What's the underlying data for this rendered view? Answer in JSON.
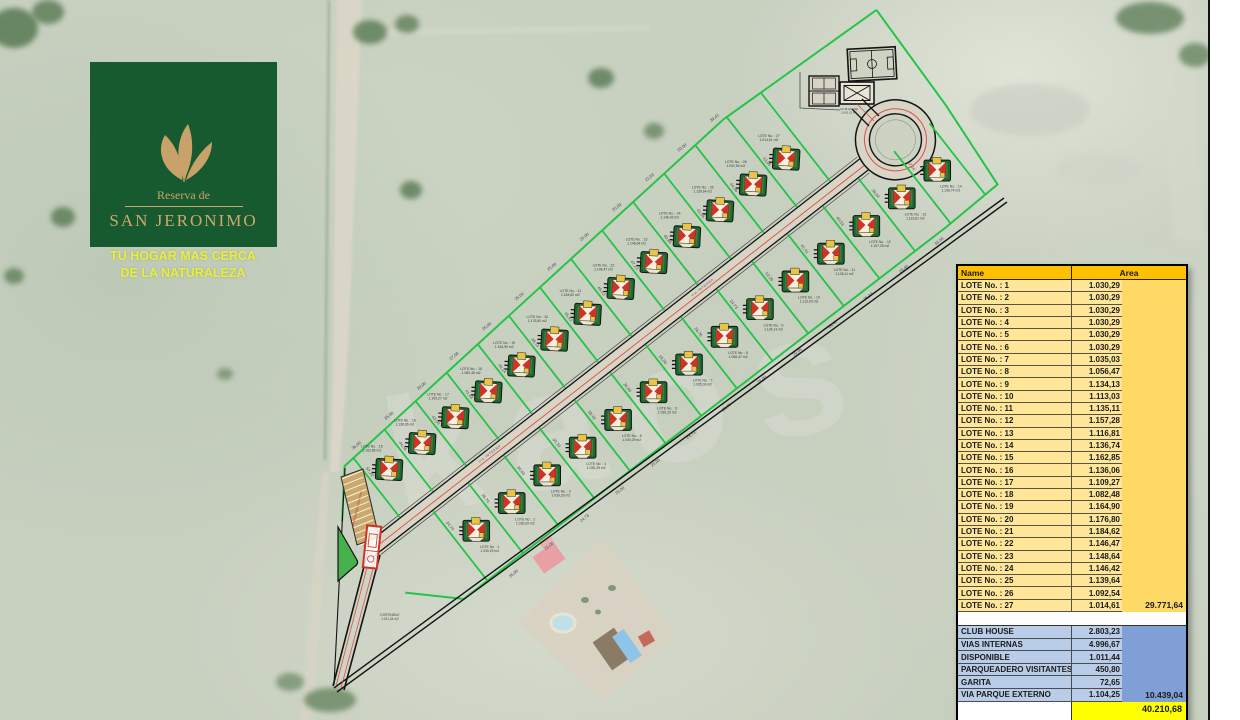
{
  "logo": {
    "brand_line1": "Reserva de",
    "brand_line2": "SAN JERONIMO",
    "tagline_line1": "TU HOGAR MAS CERCA",
    "tagline_line2": "DE LA NATURALEZA"
  },
  "table": {
    "name_header": "Name",
    "area_header": "Area",
    "lots": [
      {
        "name": "LOTE No. : 1",
        "area": "1.030,29"
      },
      {
        "name": "LOTE No. : 2",
        "area": "1.030,29"
      },
      {
        "name": "LOTE No. : 3",
        "area": "1.030,29"
      },
      {
        "name": "LOTE No. : 4",
        "area": "1.030,29"
      },
      {
        "name": "LOTE No. : 5",
        "area": "1.030,29"
      },
      {
        "name": "LOTE No. : 6",
        "area": "1.030,29"
      },
      {
        "name": "LOTE No. : 7",
        "area": "1.035,03"
      },
      {
        "name": "LOTE No. : 8",
        "area": "1.056,47"
      },
      {
        "name": "LOTE No. : 9",
        "area": "1.134,13"
      },
      {
        "name": "LOTE No. : 10",
        "area": "1.113,03"
      },
      {
        "name": "LOTE No. : 11",
        "area": "1.135,11"
      },
      {
        "name": "LOTE No. : 12",
        "area": "1.157,28"
      },
      {
        "name": "LOTE No. : 13",
        "area": "1.116,81"
      },
      {
        "name": "LOTE No. : 14",
        "area": "1.136,74"
      },
      {
        "name": "LOTE No. : 15",
        "area": "1.162,85"
      },
      {
        "name": "LOTE No. : 16",
        "area": "1.136,06"
      },
      {
        "name": "LOTE No. : 17",
        "area": "1.109,27"
      },
      {
        "name": "LOTE No. : 18",
        "area": "1.082,48"
      },
      {
        "name": "LOTE No. : 19",
        "area": "1.164,90"
      },
      {
        "name": "LOTE No. : 20",
        "area": "1.176,80"
      },
      {
        "name": "LOTE No. : 21",
        "area": "1.184,62"
      },
      {
        "name": "LOTE No. : 22",
        "area": "1.146,47"
      },
      {
        "name": "LOTE No. : 23",
        "area": "1.148,64"
      },
      {
        "name": "LOTE No. : 24",
        "area": "1.146,42"
      },
      {
        "name": "LOTE No. : 25",
        "area": "1.139,64"
      },
      {
        "name": "LOTE No. : 26",
        "area": "1.092,54"
      },
      {
        "name": "LOTE No. : 27",
        "area": "1.014,61"
      }
    ],
    "lots_subtotal": "29.771,64",
    "common": [
      {
        "name": "CLUB HOUSE",
        "area": "2.803,23"
      },
      {
        "name": "VIAS INTERNAS",
        "area": "4.996,67"
      },
      {
        "name": "DISPONIBLE",
        "area": "1.011,44"
      },
      {
        "name": "PARQUEADERO VISITANTES",
        "area": "450,80"
      },
      {
        "name": "GARITA",
        "area": "72,65"
      },
      {
        "name": "VIA PARQUE EXTERNO",
        "area": "1.104,25"
      }
    ],
    "common_subtotal": "10.439,04",
    "grand_total": "40.210,68"
  },
  "plan": {
    "watermark": "kaos",
    "road_label": "VIA INTERNA",
    "parking_label": "PARQUEADERO VISITANTES",
    "club_label_line1": "CLUB HOUSE",
    "club_label_line2": "2.803,23 m2",
    "disponible_label_line1": "DISPONIBLE",
    "disponible_label_line2": "1.011,44 m2",
    "area_suffix": "m2",
    "dims": {
      "nw_front": [
        "36,00",
        "35,00",
        "28,00",
        "27,00",
        "26,00",
        "25,00",
        "25,00",
        "25,00",
        "25,03",
        "22,03",
        "20,00",
        "39,41"
      ],
      "upper_depth": [
        "57,20",
        "44,56",
        "43,04",
        "41,63",
        "40,14",
        "38,73",
        "45,43",
        "46,03",
        "47,23",
        "40,86",
        "41,06",
        "44,06",
        "43,95"
      ],
      "lower_depth": [
        "34,74",
        "28,76",
        "36,63",
        "30,70",
        "28,42",
        "26,96",
        "29,00",
        "26,76",
        "24,73",
        "42,29",
        "41,41",
        "40,53",
        "39,02",
        "37,74"
      ],
      "se_front": [
        "26,00",
        "25,00",
        "24,73",
        "26,00",
        "25,00",
        "24,73",
        "26,76",
        "29,00",
        "26,96",
        "28,42",
        "25,33",
        "29,46",
        "33,94"
      ]
    }
  },
  "colors": {
    "lot_line": "#24c448",
    "accent_red": "#d84538",
    "table_header": "#FFC000",
    "lot_row": "#FFE699",
    "lot_total_col": "#FFD966",
    "common_row": "#B9CDE8",
    "common_total_col": "#7F9FD6",
    "grand_row": "#FFFF00",
    "logo_green": "#175a2f",
    "logo_gold": "#c8a26a",
    "slogan_yellow": "#e9ee3b"
  }
}
